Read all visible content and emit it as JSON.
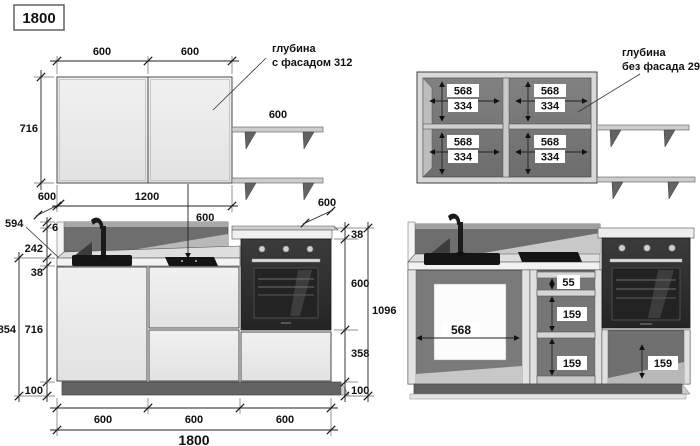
{
  "title": "1800",
  "palette": {
    "line": "#222222",
    "cabinet_face": "#ececec",
    "interior_gray": "#757575",
    "worktop": "#e0e0e0",
    "backsplash": "#6e6e6e",
    "plinth": "#636363",
    "oven_body": "#2e2e2e",
    "appliance_black": "#151515"
  },
  "upper_front": {
    "dim_door_left": "600",
    "dim_door_right": "600",
    "dim_height": "716",
    "dim_shelf": "600",
    "note_line1": "глубина",
    "note_line2": "с фасадом 312"
  },
  "upper_internal": {
    "compartments": [
      {
        "w": "568",
        "h": "334"
      },
      {
        "w": "568",
        "h": "334"
      },
      {
        "w": "568",
        "h": "334"
      },
      {
        "w": "568",
        "h": "334"
      }
    ],
    "note_line1": "глубина",
    "note_line2": "без фасада 296"
  },
  "lower_front": {
    "dim_depth_left": "600",
    "dim_width_upper": "1200",
    "dim_gap": "600",
    "dim_depth_right": "600",
    "dim_counter": "594",
    "dim_panel": "6",
    "dim_splash": "242",
    "dim_worktop": "38",
    "dim_total_left": "854",
    "dim_carcass": "716",
    "dim_plinth_left": "100",
    "dim_oven_top": "38",
    "dim_oven": "600",
    "dim_lower": "358",
    "dim_plinth_right": "100",
    "dim_total_right": "1096",
    "dim_w1": "600",
    "dim_w2": "600",
    "dim_w3": "600",
    "dim_total_width": "1800"
  },
  "lower_internal": {
    "dim_sink_width": "568",
    "dim_drawer_top": "55",
    "dim_drawer_mid": "159",
    "dim_drawer_bottom": "159",
    "dim_oven_drawer": "159"
  }
}
